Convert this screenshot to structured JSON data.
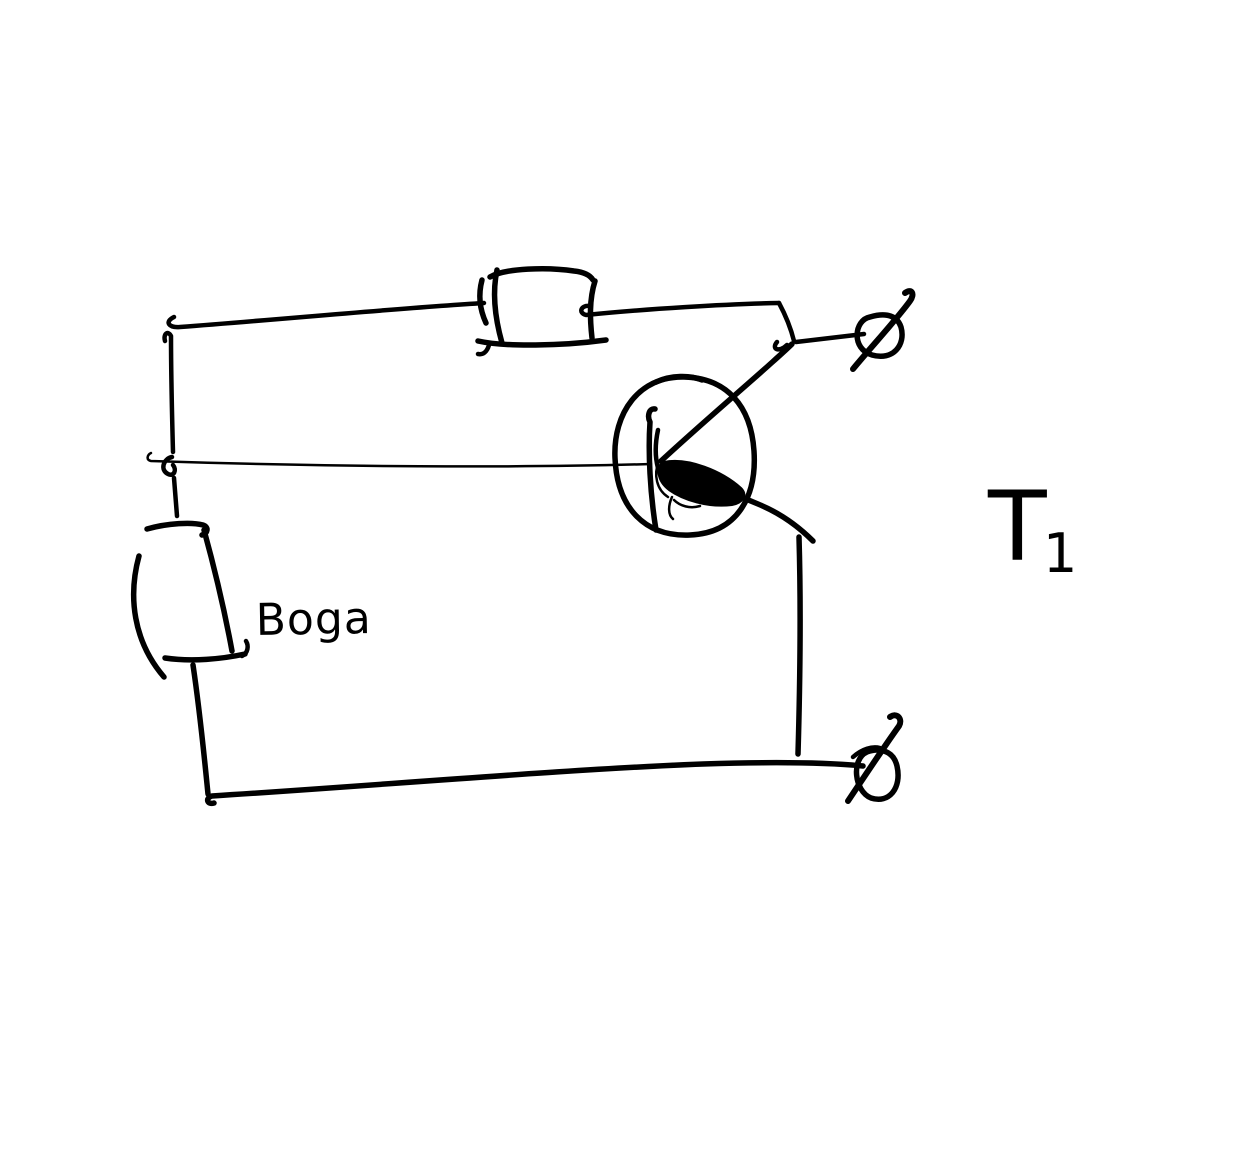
{
  "canvas": {
    "width": 1257,
    "height": 1159,
    "background_color": "#ffffff",
    "ink_color": "#000000"
  },
  "labels": {
    "battery": "Boga",
    "transistor": "T",
    "transistor_subscript": "1"
  },
  "drawn_symbols": [
    "top-wire",
    "resistor-rectangle",
    "transistor-circle",
    "transistor-base-bar",
    "transistor-collector-line",
    "transistor-emitter-line",
    "transistor-emitter-arrow",
    "battery-rectangle",
    "base-wire",
    "bottom-wire",
    "terminal-slashed-circle-top-right",
    "terminal-slashed-circle-bottom-right"
  ]
}
